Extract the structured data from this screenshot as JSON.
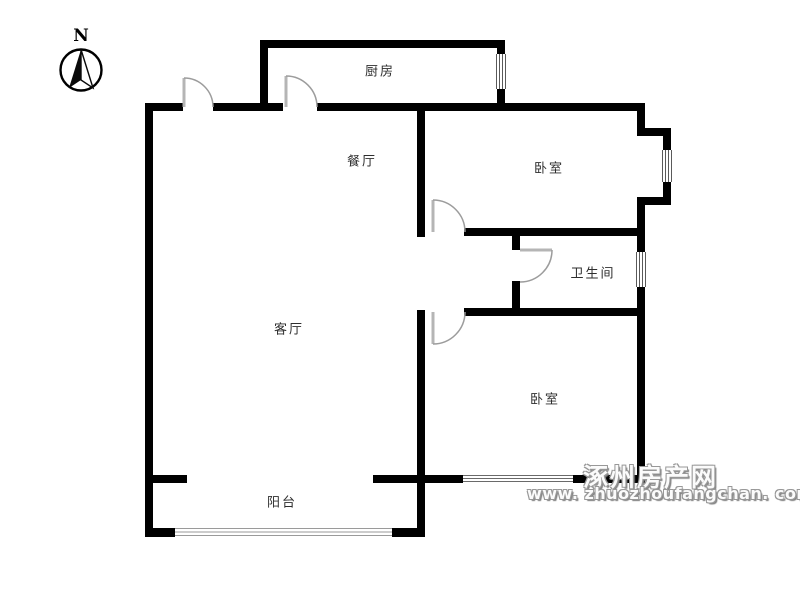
{
  "compass": {
    "north_label": "N"
  },
  "rooms": {
    "kitchen": {
      "label": "厨房"
    },
    "dining": {
      "label": "餐厅"
    },
    "bedroom_top": {
      "label": "卧室"
    },
    "bathroom": {
      "label": "卫生间"
    },
    "living": {
      "label": "客厅"
    },
    "bedroom_bottom": {
      "label": "卧室"
    },
    "balcony": {
      "label": "阳台"
    }
  },
  "watermark": {
    "site_name": "涿州房产网",
    "site_url": "www. zhuozhoufangchan. com"
  },
  "colors": {
    "wall": "#000000",
    "door_arc": "#9c9c9c",
    "label_text": "#2e2e2e",
    "watermark_gray": "#989898"
  }
}
